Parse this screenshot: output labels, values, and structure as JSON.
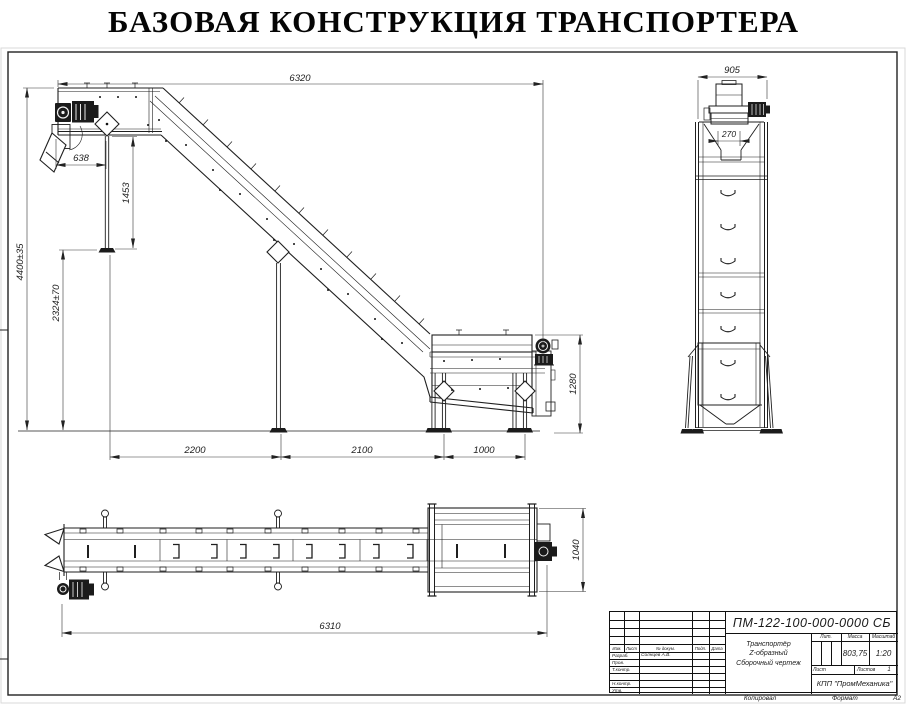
{
  "page_title": "БАЗОВАЯ КОНСТРУКЦИЯ ТРАНСПОРТЕРА",
  "side_view": {
    "dim_total_length": "6320",
    "dim_head_offset": "638",
    "dim_head_leg": "1453",
    "dim_total_height": "4400±35",
    "dim_support_height": "2324±70",
    "dim_span_a": "2200",
    "dim_span_b": "2100",
    "dim_span_c": "1000",
    "dim_infeed_height": "1280"
  },
  "end_view": {
    "dim_width": "905",
    "dim_chute": "270"
  },
  "plan_view": {
    "dim_length": "6310",
    "dim_width": "1040"
  },
  "title_block": {
    "doc_number": "ПМ-122-100-000-0000 СБ",
    "product_line1": "Транспортёр",
    "product_line2": "Z-образный",
    "product_line3": "Сборочный чертеж",
    "cols": {
      "izm": "Изм.",
      "list": "Лист",
      "doc": "№ докум.",
      "sign": "Подп.",
      "date": "Дата"
    },
    "rows": {
      "developed": "Разраб.",
      "developer_name": "Солнцев А.В.",
      "checked": "Пров.",
      "tcontrol": "Т.контр.",
      "ncontrol": "Н.контр.",
      "approved": "Утв."
    },
    "lit_label": "Лит.",
    "mass_label": "Масса",
    "scale_label": "Масштаб",
    "mass": "803,75",
    "scale": "1:20",
    "sheet_label": "Лист",
    "sheets_label": "Листов",
    "sheets_value": "1",
    "company": "КПП \"ПромМеханика\""
  },
  "footer": {
    "copied": "Копировал",
    "format_label": "Формат",
    "format_value": "А2"
  }
}
